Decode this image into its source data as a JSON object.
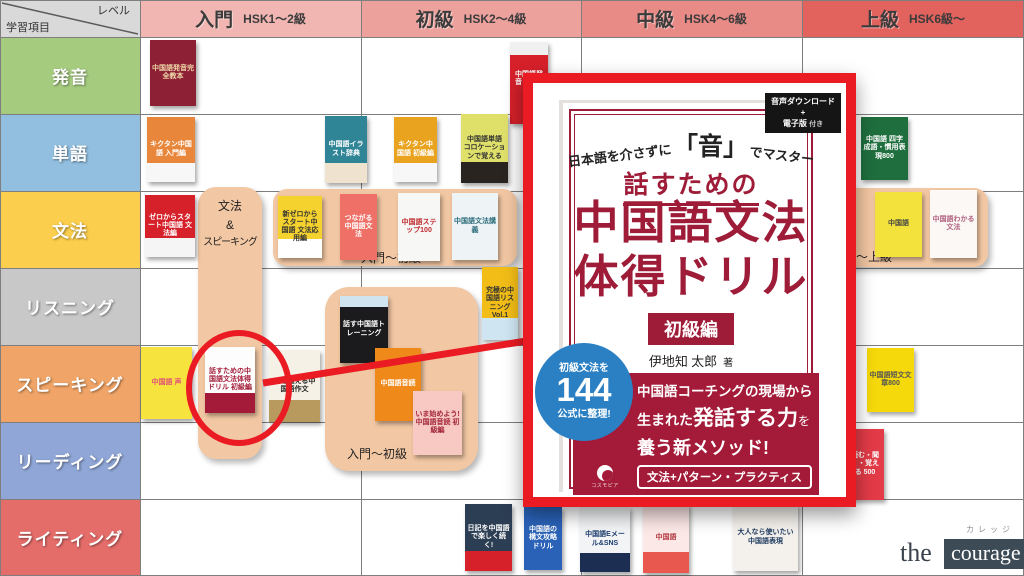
{
  "highlight_color": "#ea1b23",
  "header": {
    "corner": {
      "top": "レベル",
      "bottom": "学習項目",
      "bg": "#d9d9d9"
    },
    "levels": [
      {
        "name": "入門",
        "range": "HSK1〜2級",
        "bg": "#f1b6b2"
      },
      {
        "name": "初級",
        "range": "HSK2〜4級",
        "bg": "#eda19d"
      },
      {
        "name": "中級",
        "range": "HSK4〜6級",
        "bg": "#e88a85"
      },
      {
        "name": "上級",
        "range": "HSK6級〜",
        "bg": "#e2625e"
      }
    ]
  },
  "rows": [
    {
      "label": "発音",
      "bg": "#a5cb7f"
    },
    {
      "label": "単語",
      "bg": "#92bfdf"
    },
    {
      "label": "文法",
      "bg": "#fcce4d"
    },
    {
      "label": "リスニング",
      "bg": "#c8c8c8"
    },
    {
      "label": "スピーキング",
      "bg": "#f0a467"
    },
    {
      "label": "リーディング",
      "bg": "#8fa6d6"
    },
    {
      "label": "ライティング",
      "bg": "#e46d6a"
    }
  ],
  "band_label": {
    "l1": "文法",
    "l2": "&",
    "l3": "スピーキング"
  },
  "groups": [
    {
      "label": "入門〜初級",
      "x": 273,
      "y": 189,
      "w": 244,
      "h": 77,
      "r": 14,
      "lx": 88,
      "ly": 60
    },
    {
      "label": "入門〜初級",
      "x": 325,
      "y": 287,
      "w": 153,
      "h": 184,
      "r": 24,
      "lx": 22,
      "ly": 158
    },
    {
      "label": "中級〜上級",
      "x": 788,
      "y": 188,
      "w": 200,
      "h": 79,
      "r": 14,
      "lx": 44,
      "ly": 60
    }
  ],
  "books": [
    {
      "title": "中国語発音完全教本",
      "x": 150,
      "y": 40,
      "w": 46,
      "h": 66,
      "bg": "#8e2036",
      "fg": "#efd9a8"
    },
    {
      "title": "中国語発音レッスン",
      "x": 510,
      "y": 42,
      "w": 38,
      "h": 82,
      "bg": "#d6202a",
      "fg": "#ffffff",
      "top": "#f0f0f0"
    },
    {
      "title": "キクタン中国語 入門編",
      "x": 147,
      "y": 117,
      "w": 48,
      "h": 65,
      "bg": "#e8873b",
      "fg": "#ffffff",
      "band": "#f7f7f7"
    },
    {
      "title": "中国語イラスト辞典",
      "x": 325,
      "y": 116,
      "w": 42,
      "h": 67,
      "bg": "#2f8496",
      "fg": "#ffffff",
      "band": "#efe3cf"
    },
    {
      "title": "キクタン中国語 初級編",
      "x": 394,
      "y": 117,
      "w": 43,
      "h": 65,
      "bg": "#e9a31f",
      "fg": "#ffffff",
      "band": "#f7f7f7"
    },
    {
      "title": "中国語単語 コロケーションで覚える",
      "x": 461,
      "y": 114,
      "w": 47,
      "h": 69,
      "bg": "#dfe06a",
      "fg": "#333333",
      "band": "#2a2420"
    },
    {
      "title": "中国語 四字成語・慣用表現800",
      "x": 861,
      "y": 117,
      "w": 47,
      "h": 63,
      "bg": "#1f6f3e",
      "fg": "#ffffff"
    },
    {
      "title": "ゼロからスタート中国語 文法編",
      "x": 145,
      "y": 195,
      "w": 50,
      "h": 62,
      "bg": "#d6202a",
      "fg": "#ffffff",
      "band": "#f5f5f5"
    },
    {
      "title": "新ゼロからスタート中国語 文法応用編",
      "x": 278,
      "y": 196,
      "w": 44,
      "h": 62,
      "bg": "#f5d22e",
      "fg": "#333333",
      "band": "#ffffff"
    },
    {
      "title": "つながる中国語文法",
      "x": 340,
      "y": 194,
      "w": 37,
      "h": 66,
      "bg": "#ef7066",
      "fg": "#ffffff"
    },
    {
      "title": "中国語ステップ100",
      "x": 398,
      "y": 193,
      "w": 42,
      "h": 68,
      "bg": "#f7f7f5",
      "fg": "#c02a30"
    },
    {
      "title": "中国語文法講義",
      "x": 452,
      "y": 193,
      "w": 46,
      "h": 67,
      "bg": "#eef4f6",
      "fg": "#2a6b7a"
    },
    {
      "title": "中国語",
      "x": 875,
      "y": 192,
      "w": 47,
      "h": 65,
      "bg": "#f3e23c",
      "fg": "#444444"
    },
    {
      "title": "中国語わかる文法",
      "x": 930,
      "y": 190,
      "w": 47,
      "h": 68,
      "bg": "#fbf8f5",
      "fg": "#b06080"
    },
    {
      "title": "究極の中国語リスニング Vol.1",
      "x": 482,
      "y": 267,
      "w": 36,
      "h": 73,
      "bg": "#f2bd16",
      "fg": "#333333",
      "band": "#cfe6f2"
    },
    {
      "title": "話す中国語トレーニング",
      "x": 340,
      "y": 296,
      "w": 48,
      "h": 67,
      "bg": "#1b1b1d",
      "fg": "#ffffff",
      "top": "#cfe4ef"
    },
    {
      "title": "中国語音読",
      "x": 375,
      "y": 348,
      "w": 46,
      "h": 73,
      "bg": "#ef8a1a",
      "fg": "#ffffff"
    },
    {
      "title": "いま始めよう! 中国語音読 初級編",
      "x": 413,
      "y": 391,
      "w": 49,
      "h": 64,
      "bg": "#f7c9c2",
      "fg": "#a32638"
    },
    {
      "title": "中国語 声",
      "x": 141,
      "y": 347,
      "w": 51,
      "h": 72,
      "bg": "#f6e33e",
      "fg": "#e0507a"
    },
    {
      "title": "話すための中国語文法体得ドリル 初級編",
      "x": 205,
      "y": 347,
      "w": 50,
      "h": 66,
      "bg": "#fdfdfd",
      "fg": "#a31b38",
      "band": "#a31b38"
    },
    {
      "title": "口を鍛える中国語作文",
      "x": 269,
      "y": 350,
      "w": 51,
      "h": 72,
      "bg": "#f5f1e6",
      "fg": "#222222",
      "band": "#b89a5e"
    },
    {
      "title": "中国語短文文章800",
      "x": 867,
      "y": 348,
      "w": 47,
      "h": 64,
      "bg": "#f5d90a",
      "fg": "#555555"
    },
    {
      "title": "読む・聞く・覚える 500",
      "x": 846,
      "y": 429,
      "w": 38,
      "h": 71,
      "bg": "#e33b47",
      "fg": "#ffffff"
    },
    {
      "title": "日記を中国語で楽しく続く!",
      "x": 465,
      "y": 504,
      "w": 47,
      "h": 67,
      "bg": "#2c3e54",
      "fg": "#ffffff",
      "band": "#d6202a"
    },
    {
      "title": "中国語の構文攻略ドリル",
      "x": 524,
      "y": 507,
      "w": 38,
      "h": 63,
      "bg": "#2a62b8",
      "fg": "#ffffff"
    },
    {
      "title": "中国語Eメール&SNS",
      "x": 580,
      "y": 507,
      "w": 50,
      "h": 65,
      "bg": "#f2f4f6",
      "fg": "#1c3c6e",
      "band": "#1c2f52"
    },
    {
      "title": "中国語",
      "x": 643,
      "y": 504,
      "w": 46,
      "h": 69,
      "bg": "#fce8e6",
      "fg": "#b23a42",
      "band": "#e8584f"
    },
    {
      "title": "大人なら使いたい中国語表現",
      "x": 733,
      "y": 504,
      "w": 65,
      "h": 67,
      "bg": "#f4f1ec",
      "fg": "#1e3a5f"
    }
  ],
  "featured": {
    "badge": {
      "line1": "音声ダウンロード",
      "plus": "+",
      "line2": "電子版",
      "suffix": "付き"
    },
    "tagline_pre": "日本語を介さずに",
    "tagline_sound": "「音」",
    "tagline_post": "でマスター",
    "title_top": "話すための",
    "title_line1": "中国語文法",
    "title_line2": "体得ドリル",
    "edition": "初級編",
    "author": "伊地知 太郎",
    "author_suffix": "著",
    "circle": {
      "top": "初級文法を",
      "number": "144",
      "bottom": "公式に整理!",
      "bg": "#2b80c4"
    },
    "band": {
      "line1": "中国語コーチングの現場から",
      "line2_pre": "生まれた",
      "line2_em": "発話する力",
      "line2_post": "を",
      "line3": "養う新メソッド!",
      "boxed": "文法+パターン・プラクティス",
      "bg": "#a31b38"
    },
    "publisher": "コスモピア"
  },
  "logo": {
    "kana": "カレッジ",
    "the": "the",
    "courage": "courage"
  }
}
